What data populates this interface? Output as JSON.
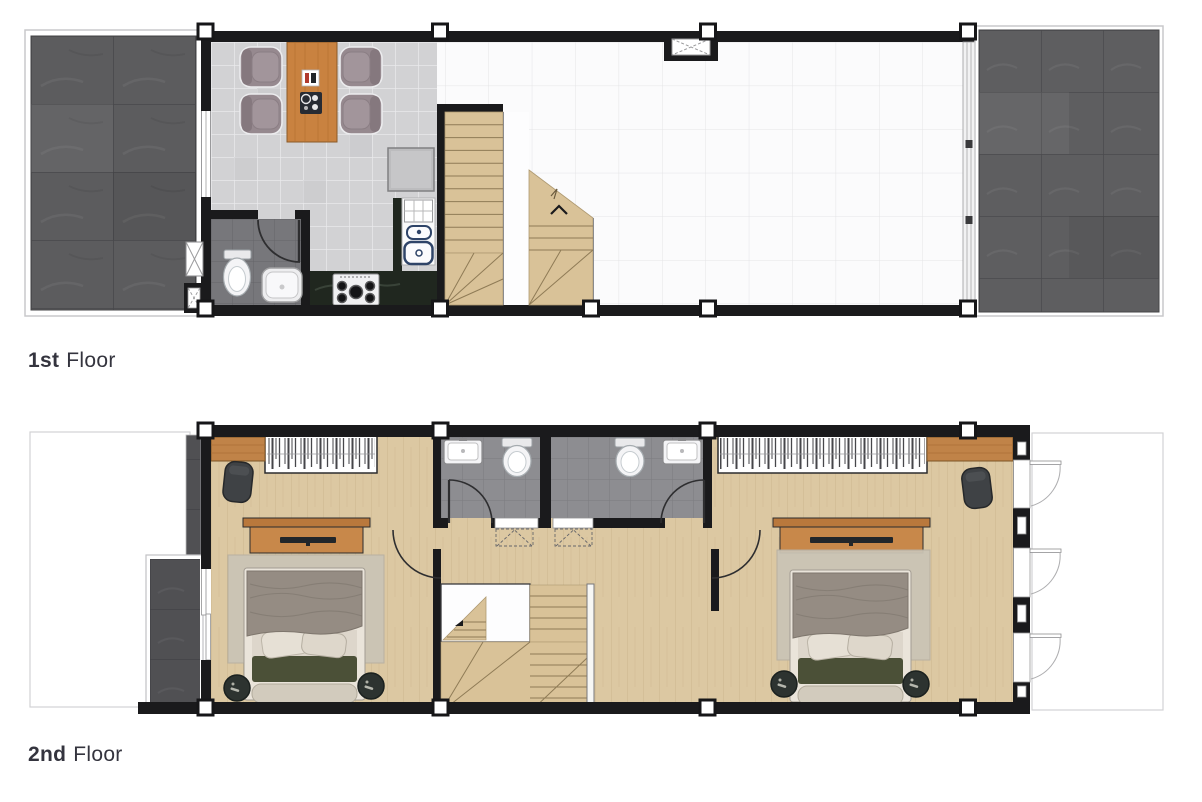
{
  "page": {
    "background": "#ffffff"
  },
  "floors": [
    {
      "id": "first",
      "label_number": "1st",
      "label_word": "Floor"
    },
    {
      "id": "second",
      "label_number": "2nd",
      "label_word": "Floor"
    }
  ],
  "palette": {
    "wall": "#1a1a1c",
    "terrace_stone": "#5b5b5d",
    "balcony_stone": "#505053",
    "kitchen_tile": "#d2d2d4",
    "bath_tile_first": "#77777b",
    "bath_tile_second": "#8d8d91",
    "wood_floor": "#dcc8a2",
    "stair_wood": "#d9c298",
    "table_wood": "#c98240",
    "cabinet_wood": "#c8884a",
    "counter_dark": "#20271f",
    "bed_blanket": "#958c83",
    "cushion_green": "#4b5037",
    "dining_chair": "#96898f",
    "armchair_dark": "#3f4245",
    "grid_line": "#e4e4e6",
    "label_text": "#34343e"
  },
  "symbols": [
    "dining-table",
    "dining-chair",
    "refrigerator",
    "stove",
    "kitchen-sink",
    "toilet",
    "washbasin",
    "staircase",
    "up-arrow",
    "shaft",
    "door-swing",
    "window",
    "casement-window",
    "wardrobe",
    "tv-console",
    "bed",
    "rug",
    "armchair",
    "pouf",
    "balcony",
    "terrace",
    "column-marker"
  ]
}
